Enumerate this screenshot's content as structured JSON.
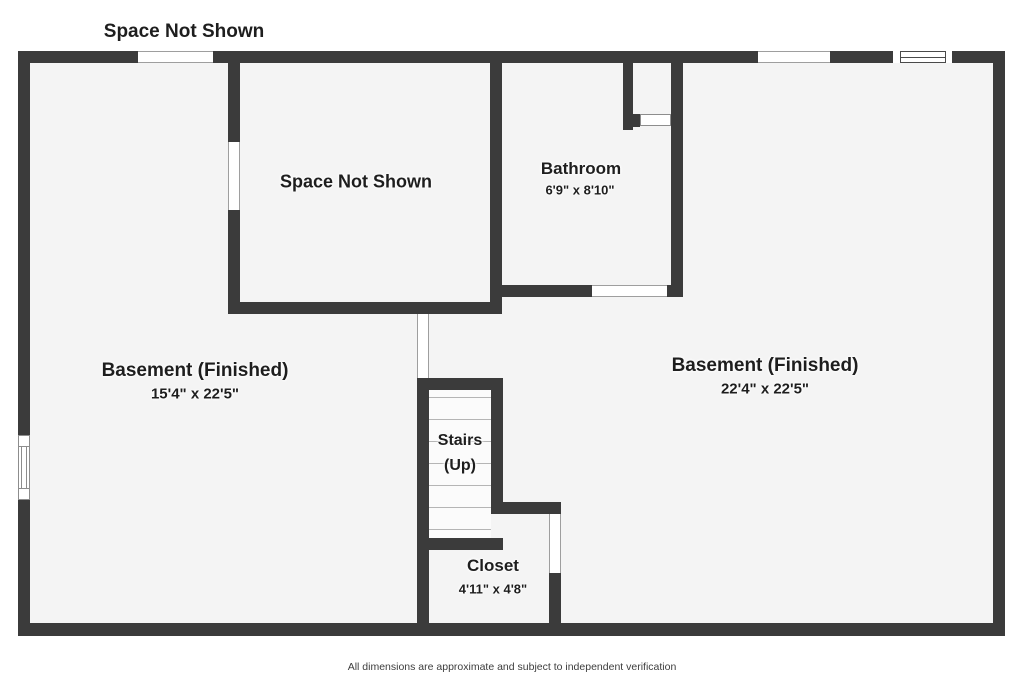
{
  "top_label": "Space Not Shown",
  "rooms": {
    "space_not_shown": {
      "name": "Space Not Shown"
    },
    "bathroom": {
      "name": "Bathroom",
      "dims": "6'9\" x 8'10\""
    },
    "basement_left": {
      "name": "Basement (Finished)",
      "dims": "15'4\" x 22'5\""
    },
    "basement_right": {
      "name": "Basement (Finished)",
      "dims": "22'4\" x 22'5\""
    },
    "stairs": {
      "name": "Stairs",
      "direction": "(Up)"
    },
    "closet": {
      "name": "Closet",
      "dims": "4'11\" x 4'8\""
    }
  },
  "footer": "All dimensions are approximate and subject to independent verification",
  "colors": {
    "wall": "#3b3b3b",
    "floor": "#f4f4f4",
    "outside": "#ffffff",
    "stairs_floor": "#fbfbfb",
    "opening_line": "#9e9e9e",
    "window_frame": "#4a4a4a",
    "window_frame_light": "#8d8d8d",
    "tread_line": "#b5b5b5",
    "text": "#1e1e1e",
    "footer_text": "#3d3d3d"
  }
}
